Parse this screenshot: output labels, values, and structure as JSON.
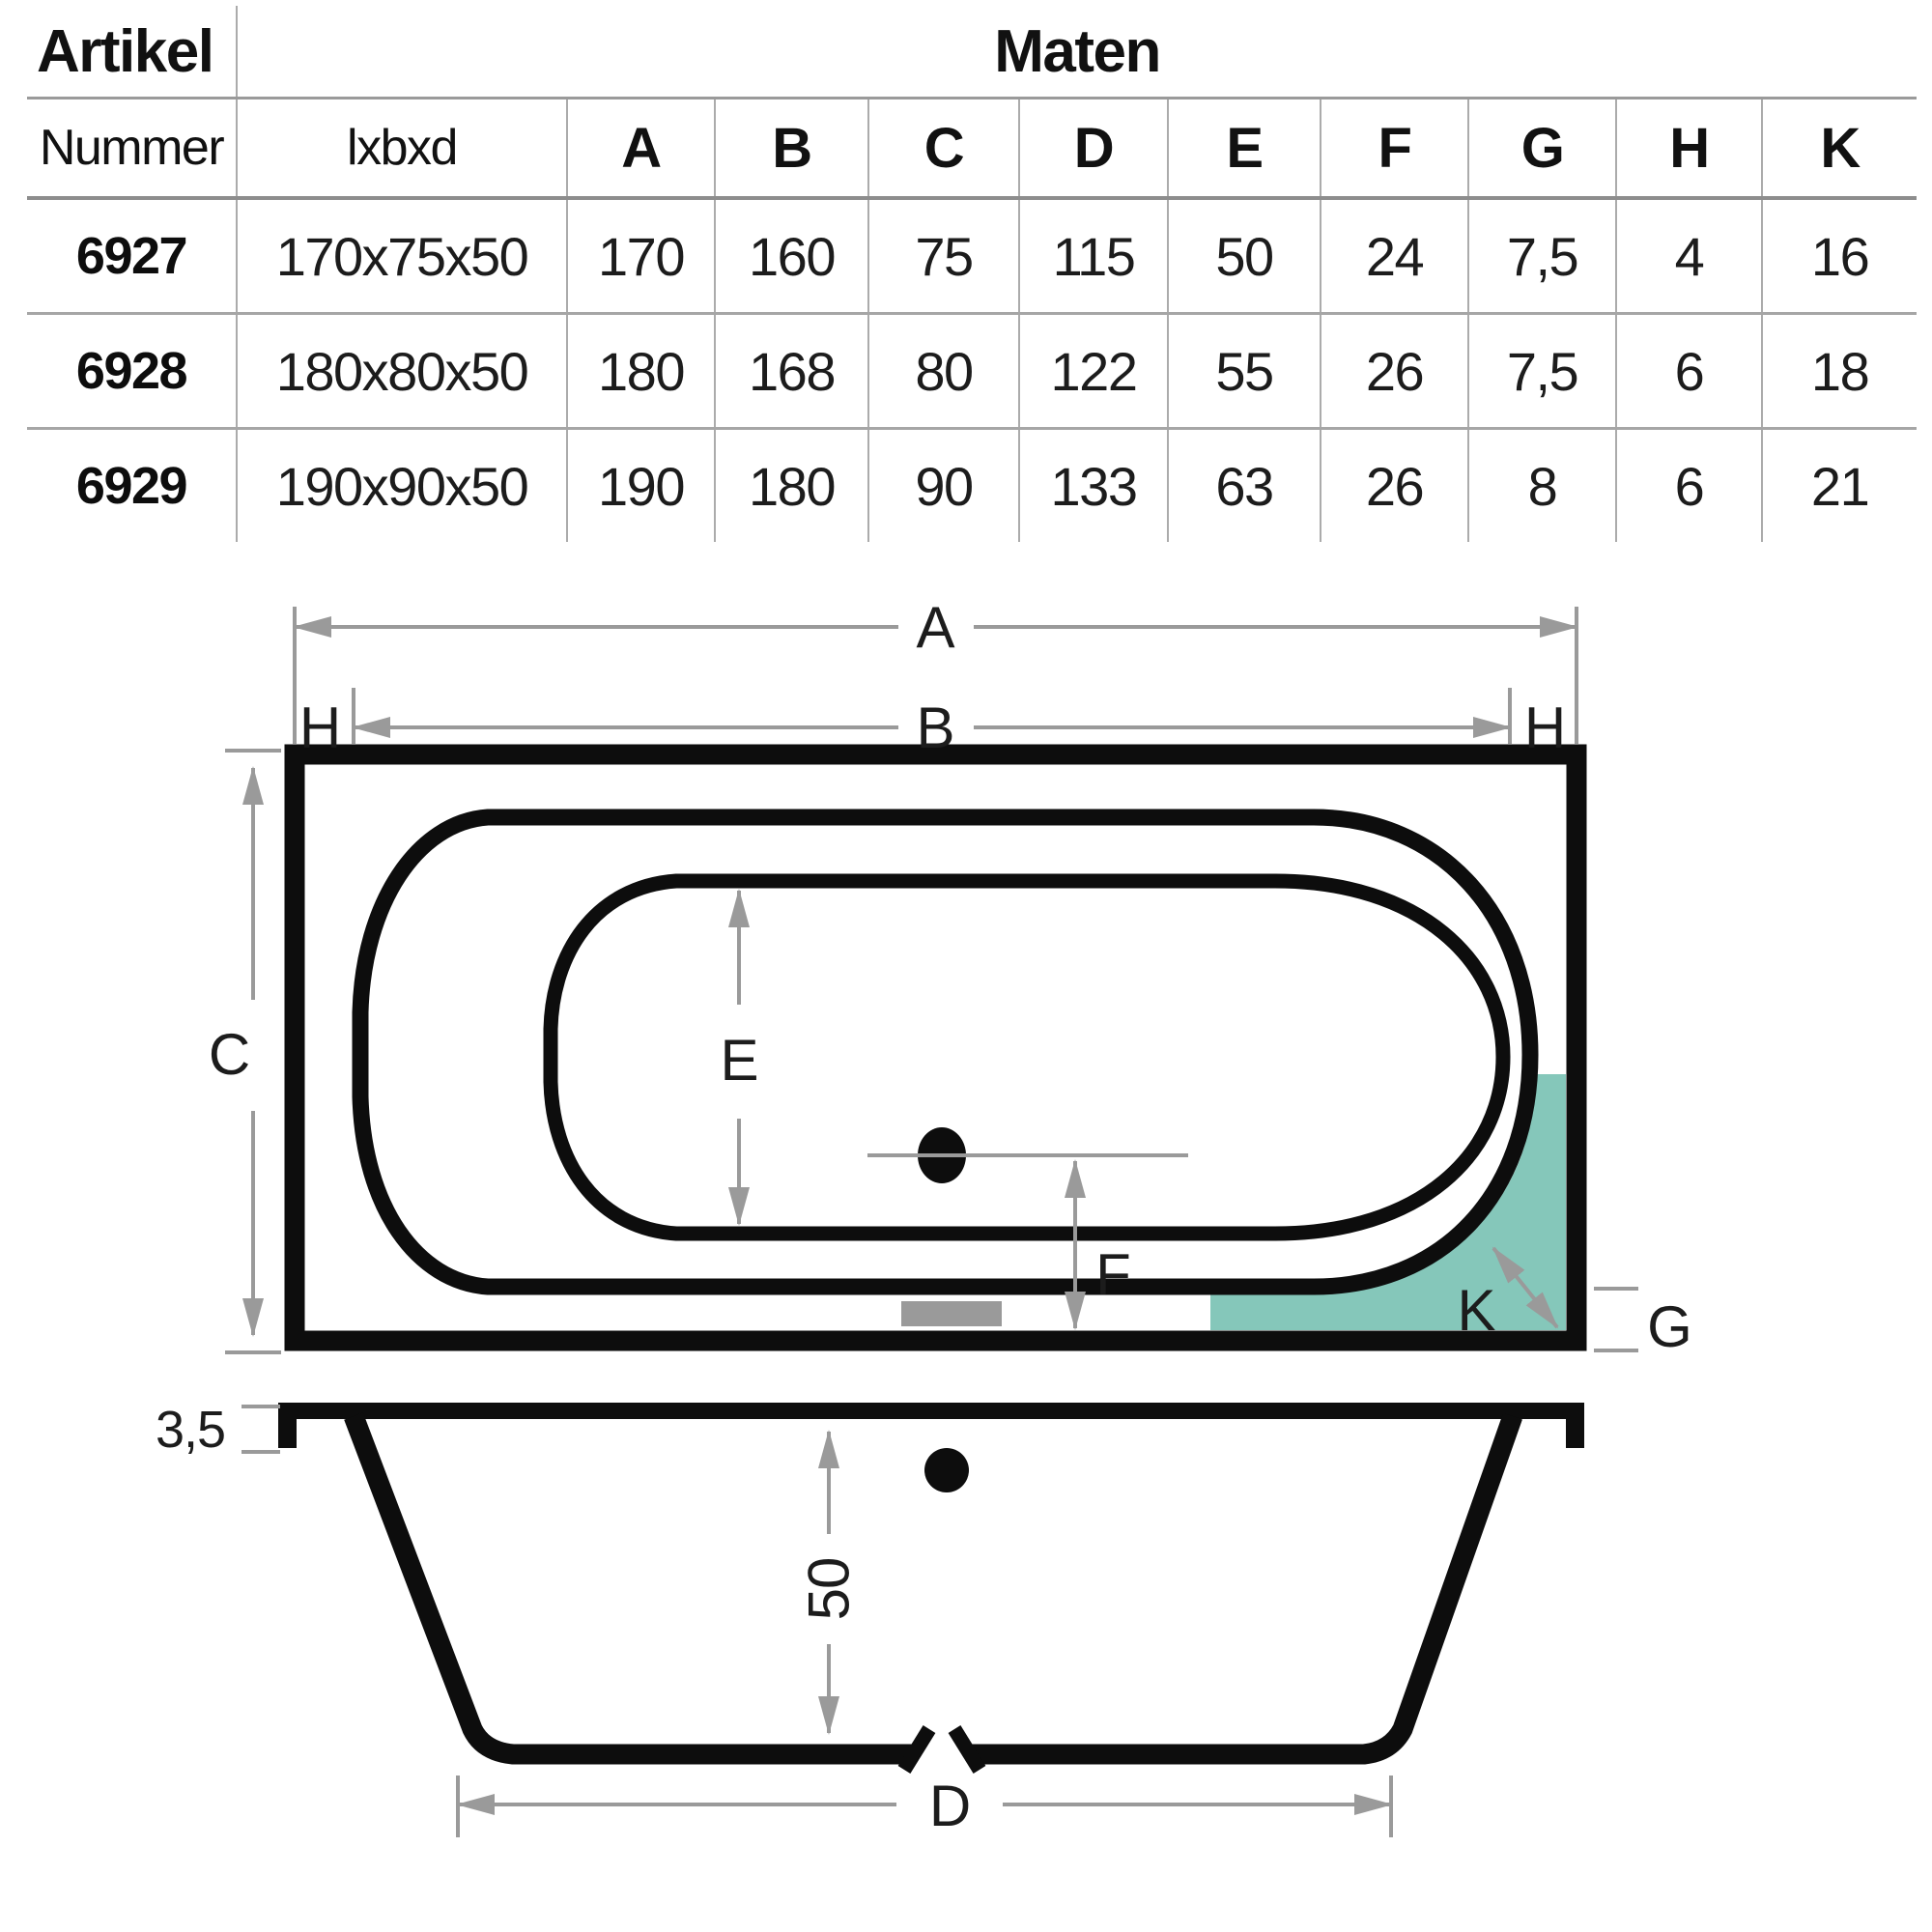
{
  "table": {
    "header": {
      "artikel": "Artikel",
      "maten": "Maten"
    },
    "columns": [
      "Nummer",
      "lxbxd",
      "A",
      "B",
      "C",
      "D",
      "E",
      "F",
      "G",
      "H",
      "K"
    ],
    "rows": [
      [
        "6927",
        "170x75x50",
        "170",
        "160",
        "75",
        "115",
        "50",
        "24",
        "7,5",
        "4",
        "16"
      ],
      [
        "6928",
        "180x80x50",
        "180",
        "168",
        "80",
        "122",
        "55",
        "26",
        "7,5",
        "6",
        "18"
      ],
      [
        "6929",
        "190x90x50",
        "190",
        "180",
        "90",
        "133",
        "63",
        "26",
        "8",
        "6",
        "21"
      ]
    ]
  },
  "diagram": {
    "top_view": {
      "dim_a": "A",
      "dim_b": "B",
      "dim_c": "C",
      "dim_e": "E",
      "dim_f": "F",
      "dim_g": "G",
      "dim_h_left": "H",
      "dim_h_right": "H",
      "dim_k": "K"
    },
    "side_view": {
      "rim_thickness": "3,5",
      "depth": "50",
      "dim_d": "D"
    },
    "colors": {
      "highlight_teal": "#85c7ba",
      "dimension_gray": "#9a9a9a",
      "line_black": "#0d0d0d"
    }
  }
}
